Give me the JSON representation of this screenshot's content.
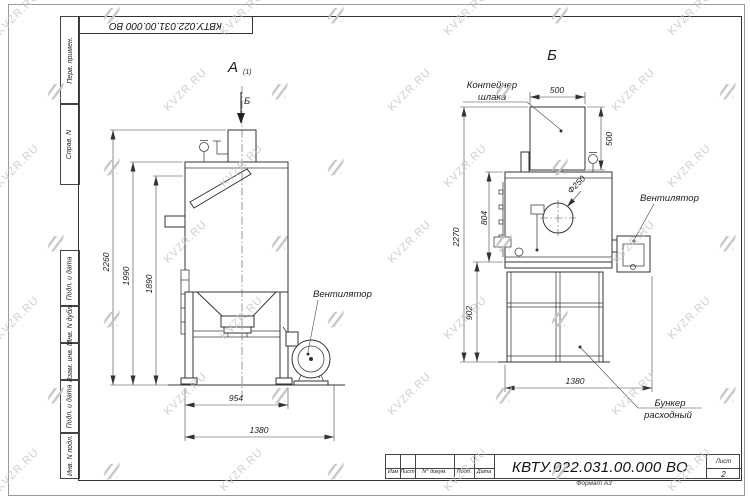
{
  "watermark": {
    "text": "KVZR.RU"
  },
  "margin": {
    "labels": [
      "Перв. примен.",
      "Справ. N",
      "Подп. и дата",
      "Инв. N дубл.",
      "Взам. инв. N",
      "Подп. и дата",
      "Инв. N подл."
    ]
  },
  "top_box": {
    "doc_number": "КВТУ.022.031.00.000  ВО"
  },
  "title_block": {
    "doc_number": "КВТУ.022.031.00.000  ВО",
    "cols": [
      "Изм",
      "Лист",
      "N° докум.",
      "Подп.",
      "Дата"
    ],
    "sheet_label": "Лист",
    "sheet_number": "2",
    "format_label": "Формат А3"
  },
  "view_a": {
    "title": "А",
    "title_sub": "(1)",
    "section_mark": "Б",
    "fan_label": "Вентилятор",
    "dim_total_height": "2260",
    "dim_body_height": "1990",
    "dim_hatch_height": "1890",
    "dim_body_width": "954",
    "dim_total_width": "1380"
  },
  "view_b": {
    "title": "Б",
    "container_label_line1": "Контейнер",
    "container_label_line2": "шлака",
    "fan_label": "Вентилятор",
    "bunker_label_line1": "Бункер",
    "bunker_label_line2": "расходный",
    "dim_container_width": "500",
    "dim_container_height": "500",
    "dim_total_height": "2270",
    "dim_body_height": "804",
    "dim_bunker_height": "902",
    "dim_total_width": "1380",
    "dim_opening_diameter": "Ф250"
  }
}
